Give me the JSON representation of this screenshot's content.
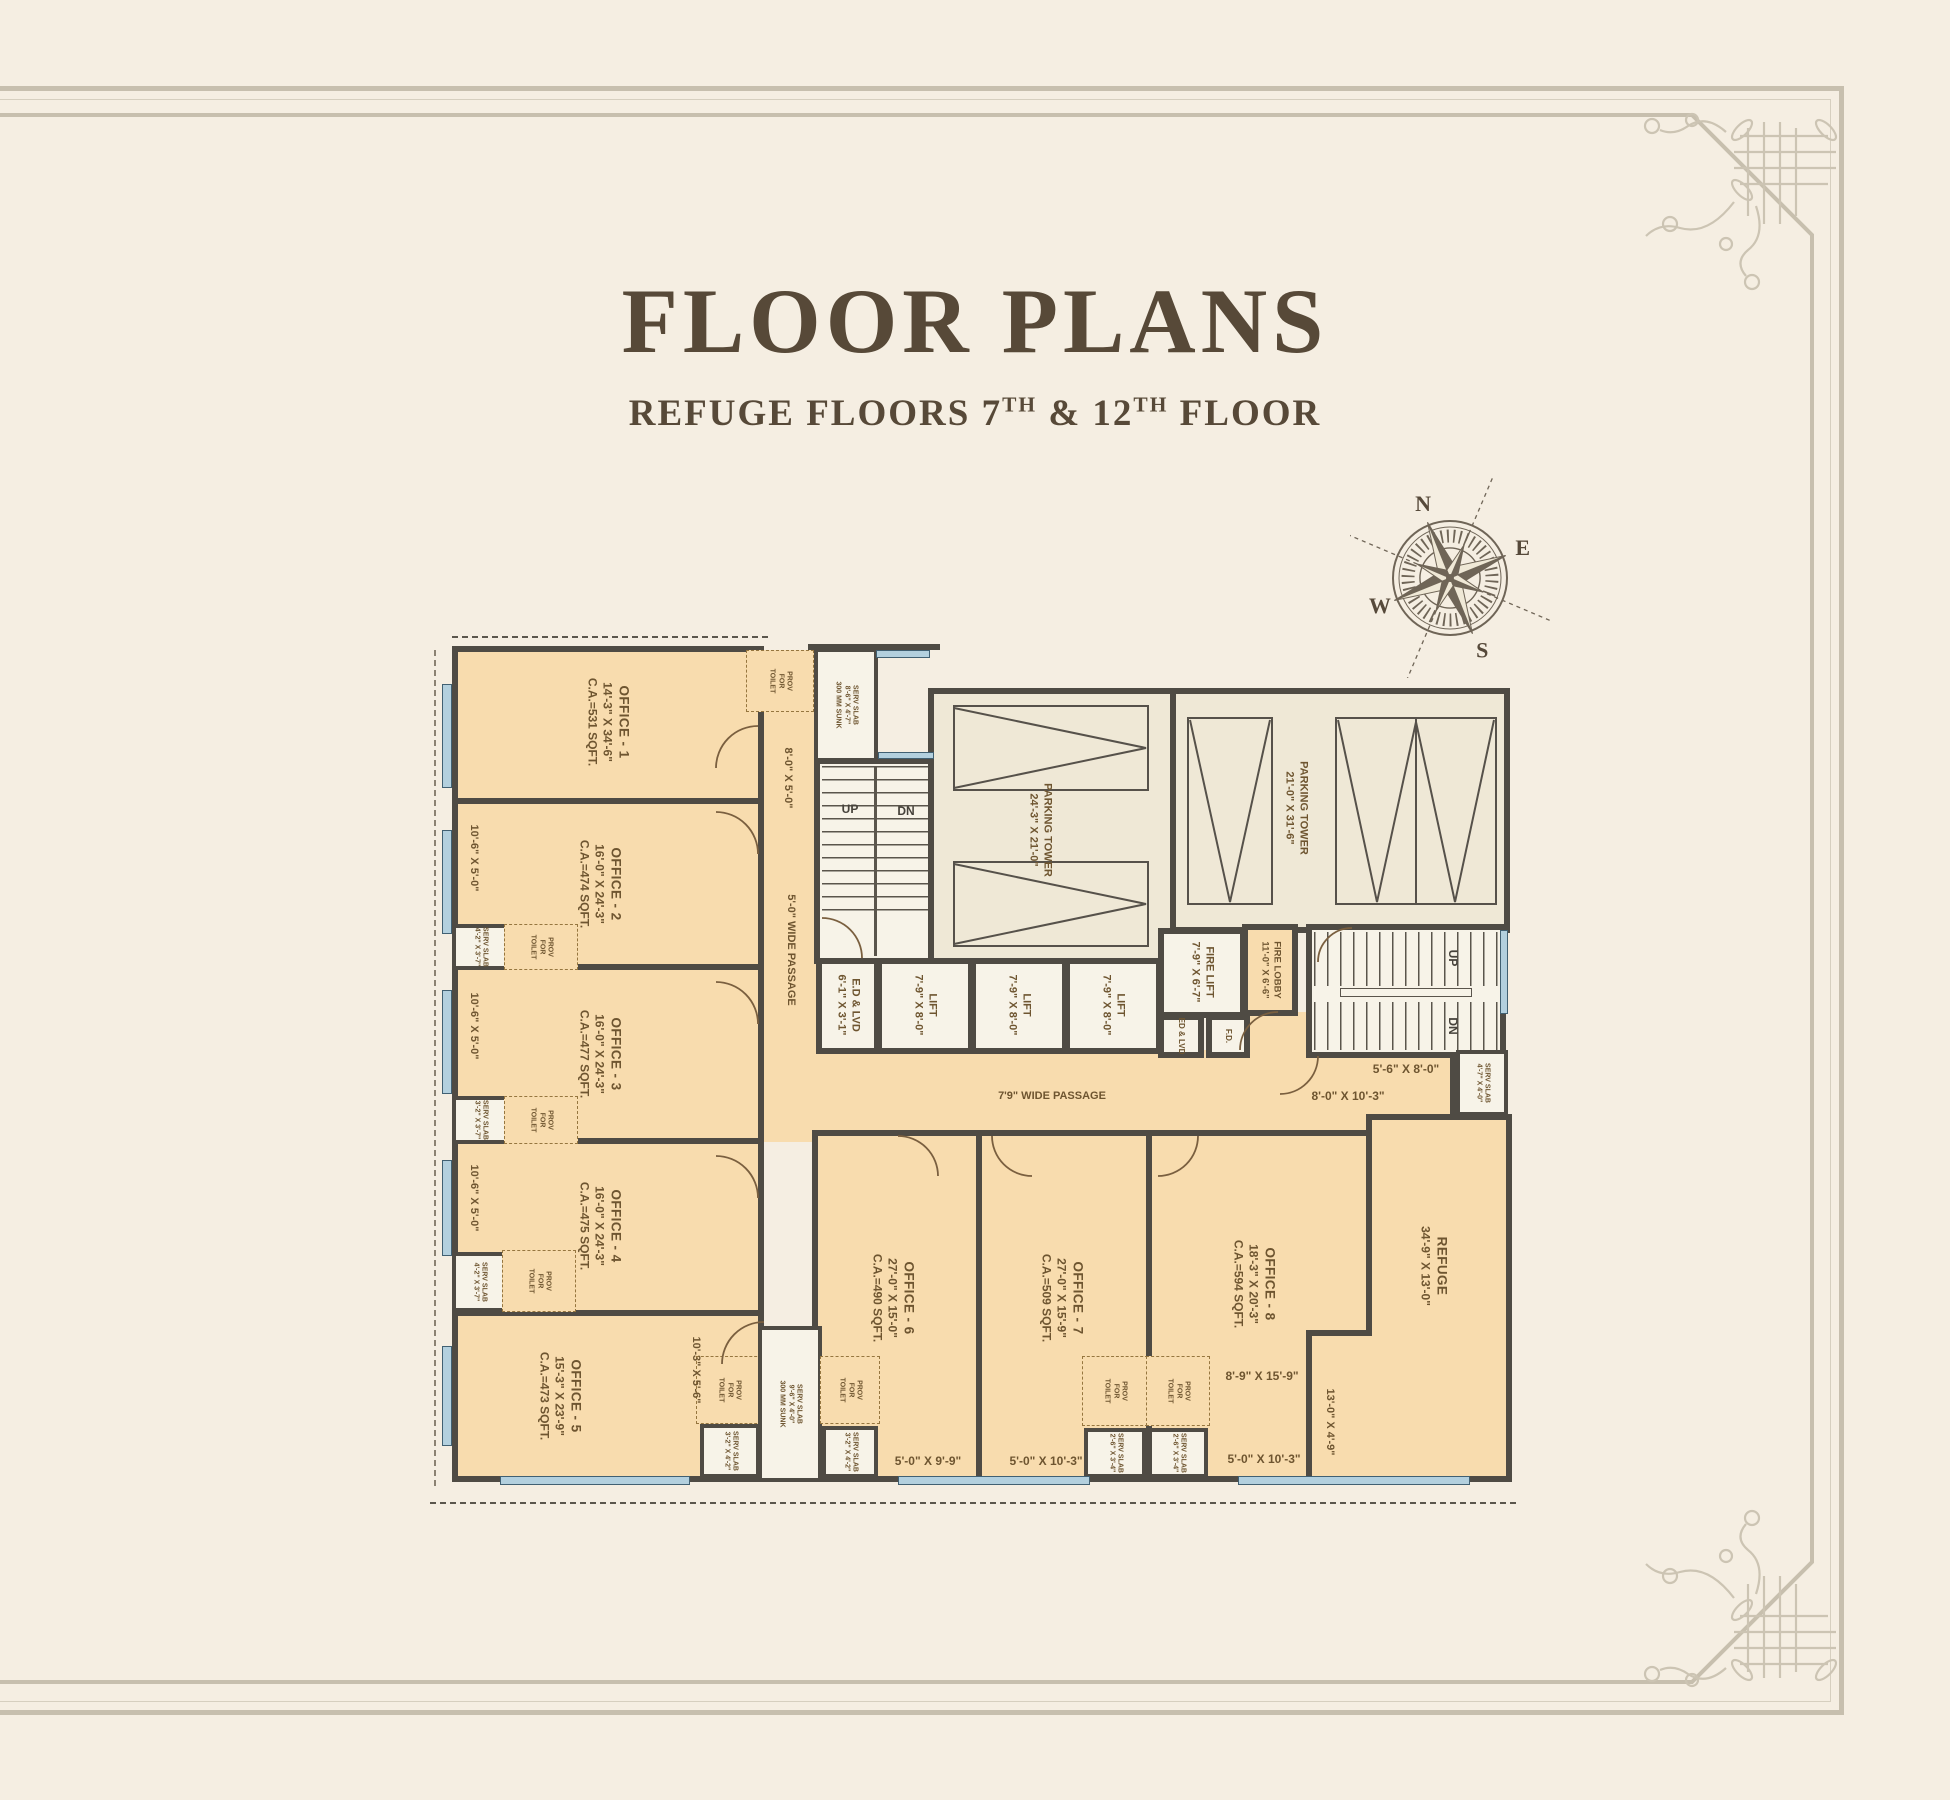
{
  "header": {
    "title": "FLOOR PLANS",
    "subtitle_pre": "REFUGE FLOORS 7",
    "subtitle_sup1": "TH",
    "subtitle_mid": " & 12",
    "subtitle_sup2": "TH",
    "subtitle_post": " FLOOR"
  },
  "compass": {
    "n": "N",
    "e": "E",
    "s": "S",
    "w": "W"
  },
  "colors": {
    "background": "#f5eee2",
    "room_fill": "#f8dcae",
    "cream": "#efe8d6",
    "wall": "#4f4b44",
    "ink": "#6e5530",
    "title": "#574938",
    "frame": "#c7bfae",
    "window": "#b3d0de"
  },
  "rooms": {
    "office1": {
      "name": "OFFICE - 1",
      "dims": "14'-3\" X 34'-6\"",
      "area": "C.A.=531 SQFT."
    },
    "office2": {
      "name": "OFFICE - 2",
      "dims": "16'-0\" X 24'-3\"",
      "area": "C.A.=474 SQFT."
    },
    "office3": {
      "name": "OFFICE - 3",
      "dims": "16'-0\" X 24'-3\"",
      "area": "C.A.=477 SQFT."
    },
    "office4": {
      "name": "OFFICE - 4",
      "dims": "16'-0\" X 24'-3\"",
      "area": "C.A.=475 SQFT."
    },
    "office5": {
      "name": "OFFICE - 5",
      "dims": "15'-3\" X 23'-9\"",
      "area": "C.A.=473 SQFT."
    },
    "office6": {
      "name": "OFFICE - 6",
      "dims": "27'-0\" X 15'-0\"",
      "area": "C.A.=490 SQFT."
    },
    "office7": {
      "name": "OFFICE - 7",
      "dims": "27'-0\" X 15'-9\"",
      "area": "C.A.=509 SQFT."
    },
    "office8": {
      "name": "OFFICE - 8",
      "dims": "18'-3\" X 20'-3\"",
      "area": "C.A.=594 SQFT."
    },
    "refuge": {
      "name": "REFUGE",
      "dims": "34'-9\" X 13'-0\""
    },
    "parking_tower_1": {
      "name": "PARKING TOWER",
      "dims": "24'-3\" X 21'-0\""
    },
    "parking_tower_2": {
      "name": "PARKING TOWER",
      "dims": "21'-0\" X 31'-6\""
    },
    "lift": {
      "name": "LIFT",
      "dims": "7'-9\" X 8'-0\""
    },
    "fire_lift": {
      "name": "FIRE LIFT",
      "dims": "7'-9\" X 6'-7\""
    },
    "fire_lobby": {
      "name": "FIRE LOBBY",
      "dims": "11'-0\" X 6'-6\""
    },
    "ed_lvd": {
      "name": "E.D & LVD",
      "dims": "6'-1\" X 3'-1\""
    },
    "ed_lvd_small": "ED & LVD",
    "fd": "F.D."
  },
  "passages": {
    "vertical": "5'-0\" WIDE PASSAGE",
    "horizontal": "7'9\" WIDE PASSAGE"
  },
  "stairs": {
    "up": "UP",
    "dn": "DN"
  },
  "dims": {
    "left_bay": "10'-6\" X 5'-0\"",
    "office1_bay": "8'-0\" X 5'-0\"",
    "office5_bay": "10'-3\" X 5'-6\"",
    "office6_bottom": "5'-0\" X 9'-9\"",
    "office7_bottom": "5'-0\" X 10'-3\"",
    "office8_mid": "8'-9\" X 15'-9\"",
    "office8_bottom": "5'-0\" X 10'-3\"",
    "refuge_strip": "13'-0\" X 4'-9\"",
    "lobby_area": "8'-0\" X 10'-3\"",
    "stair_area": "5'-6\" X 8'-0\""
  },
  "annotations": {
    "prov_toilet": "PROV FOR TOILET",
    "serv_slab_top": {
      "l1": "SERV SLAB",
      "l2": "8'-6\" X 4'-7\"",
      "l3": "300 MM SUNK"
    },
    "serv_slab_mid": {
      "l1": "SERV SLAB",
      "l2": "9'-6\" X 4'-0\"",
      "l3": "300 MM SUNK"
    },
    "serv_slab_right": {
      "l1": "SERV SLAB",
      "l2": "4'-7\" X 4'-0\""
    },
    "serv_a": {
      "l1": "SERV SLAB",
      "l2": "4'-2\" X 3'-7\""
    },
    "serv_b": {
      "l1": "SERV SLAB",
      "l2": "3'-2\" X 3'-7\""
    },
    "serv_c": {
      "l1": "SERV SLAB",
      "l2": "3'-2\" X 4'-2\""
    },
    "serv_d": {
      "l1": "SERV SLAB",
      "l2": "2'-6\" X 3'-4\""
    }
  }
}
